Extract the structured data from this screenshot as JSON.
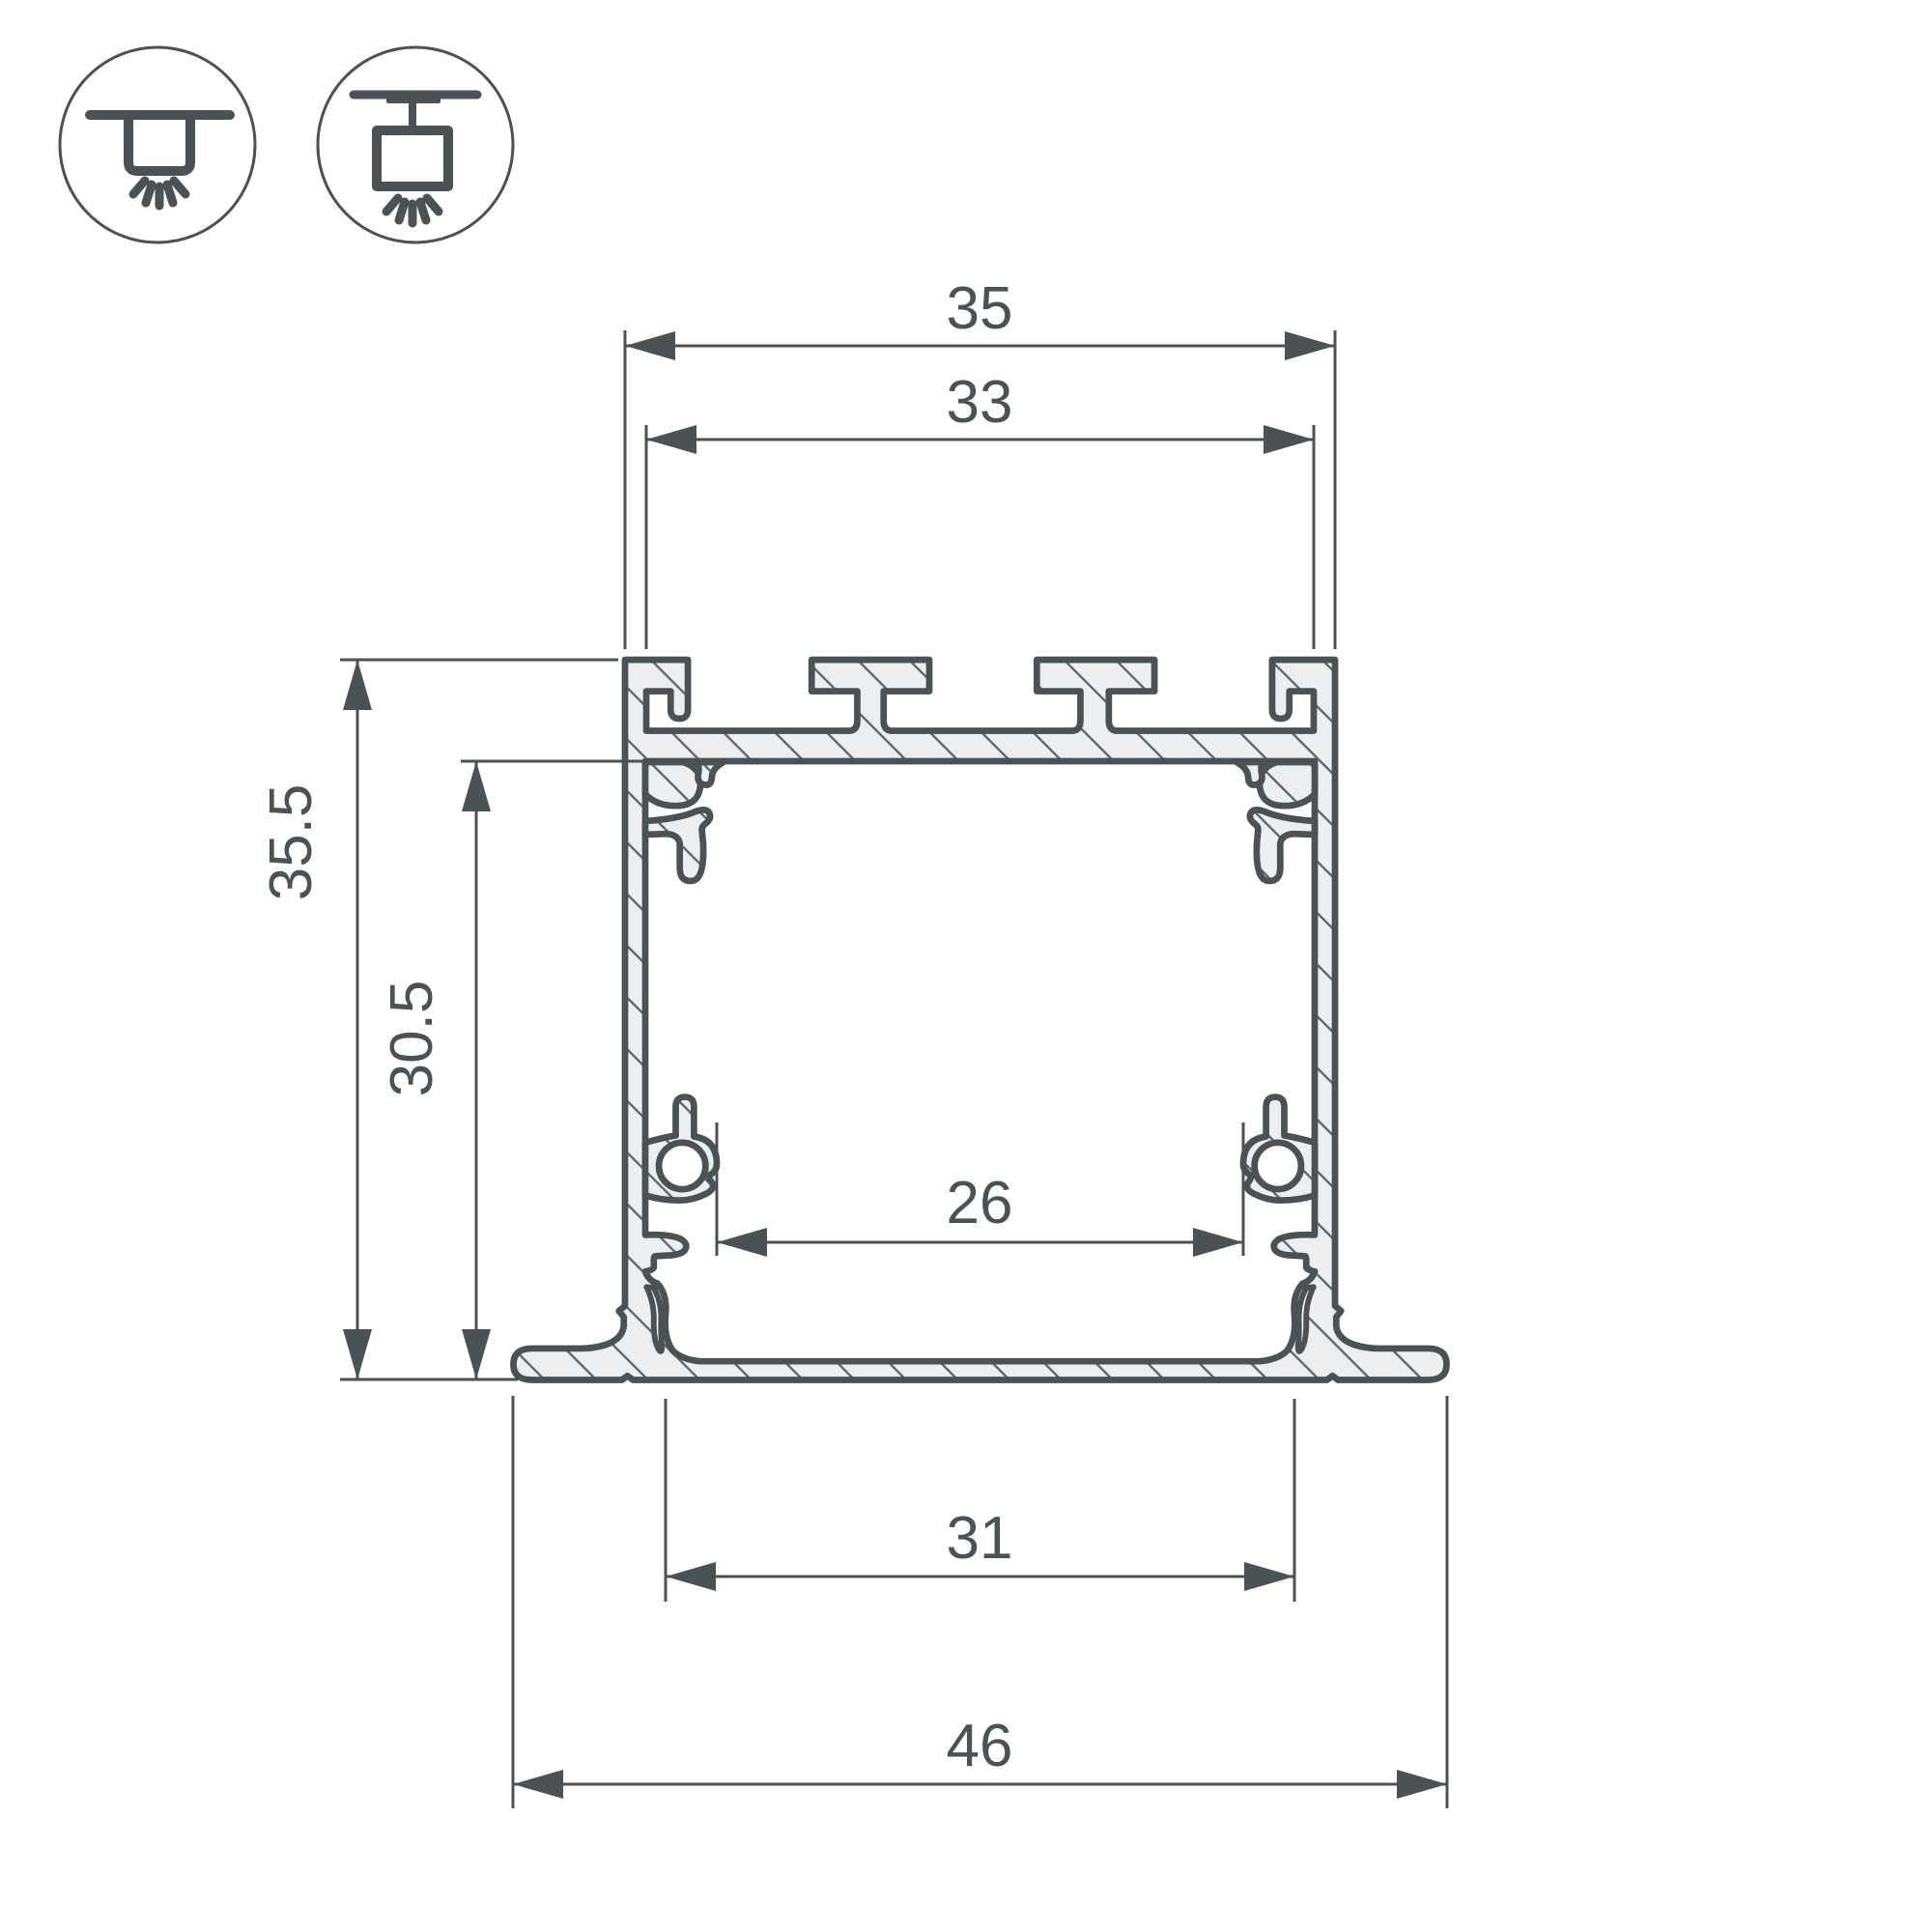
{
  "header_icons": {
    "recessed_mount_icon": "recessed-ceiling-mount",
    "surface_mount_icon": "surface-ceiling-mount"
  },
  "drawing": {
    "type": "led-profile-cross-section",
    "dimensions": {
      "top_outer_width": "35",
      "top_inner_width": "33",
      "overall_height": "35.5",
      "inner_height": "30.5",
      "clip_inner_width": "26",
      "opening_width": "31",
      "flange_overall_width": "46"
    }
  },
  "colors": {
    "line": "#4a5256",
    "material_fill": "#eceeef",
    "hatch_line": "#5a6468",
    "background": "#ffffff"
  }
}
